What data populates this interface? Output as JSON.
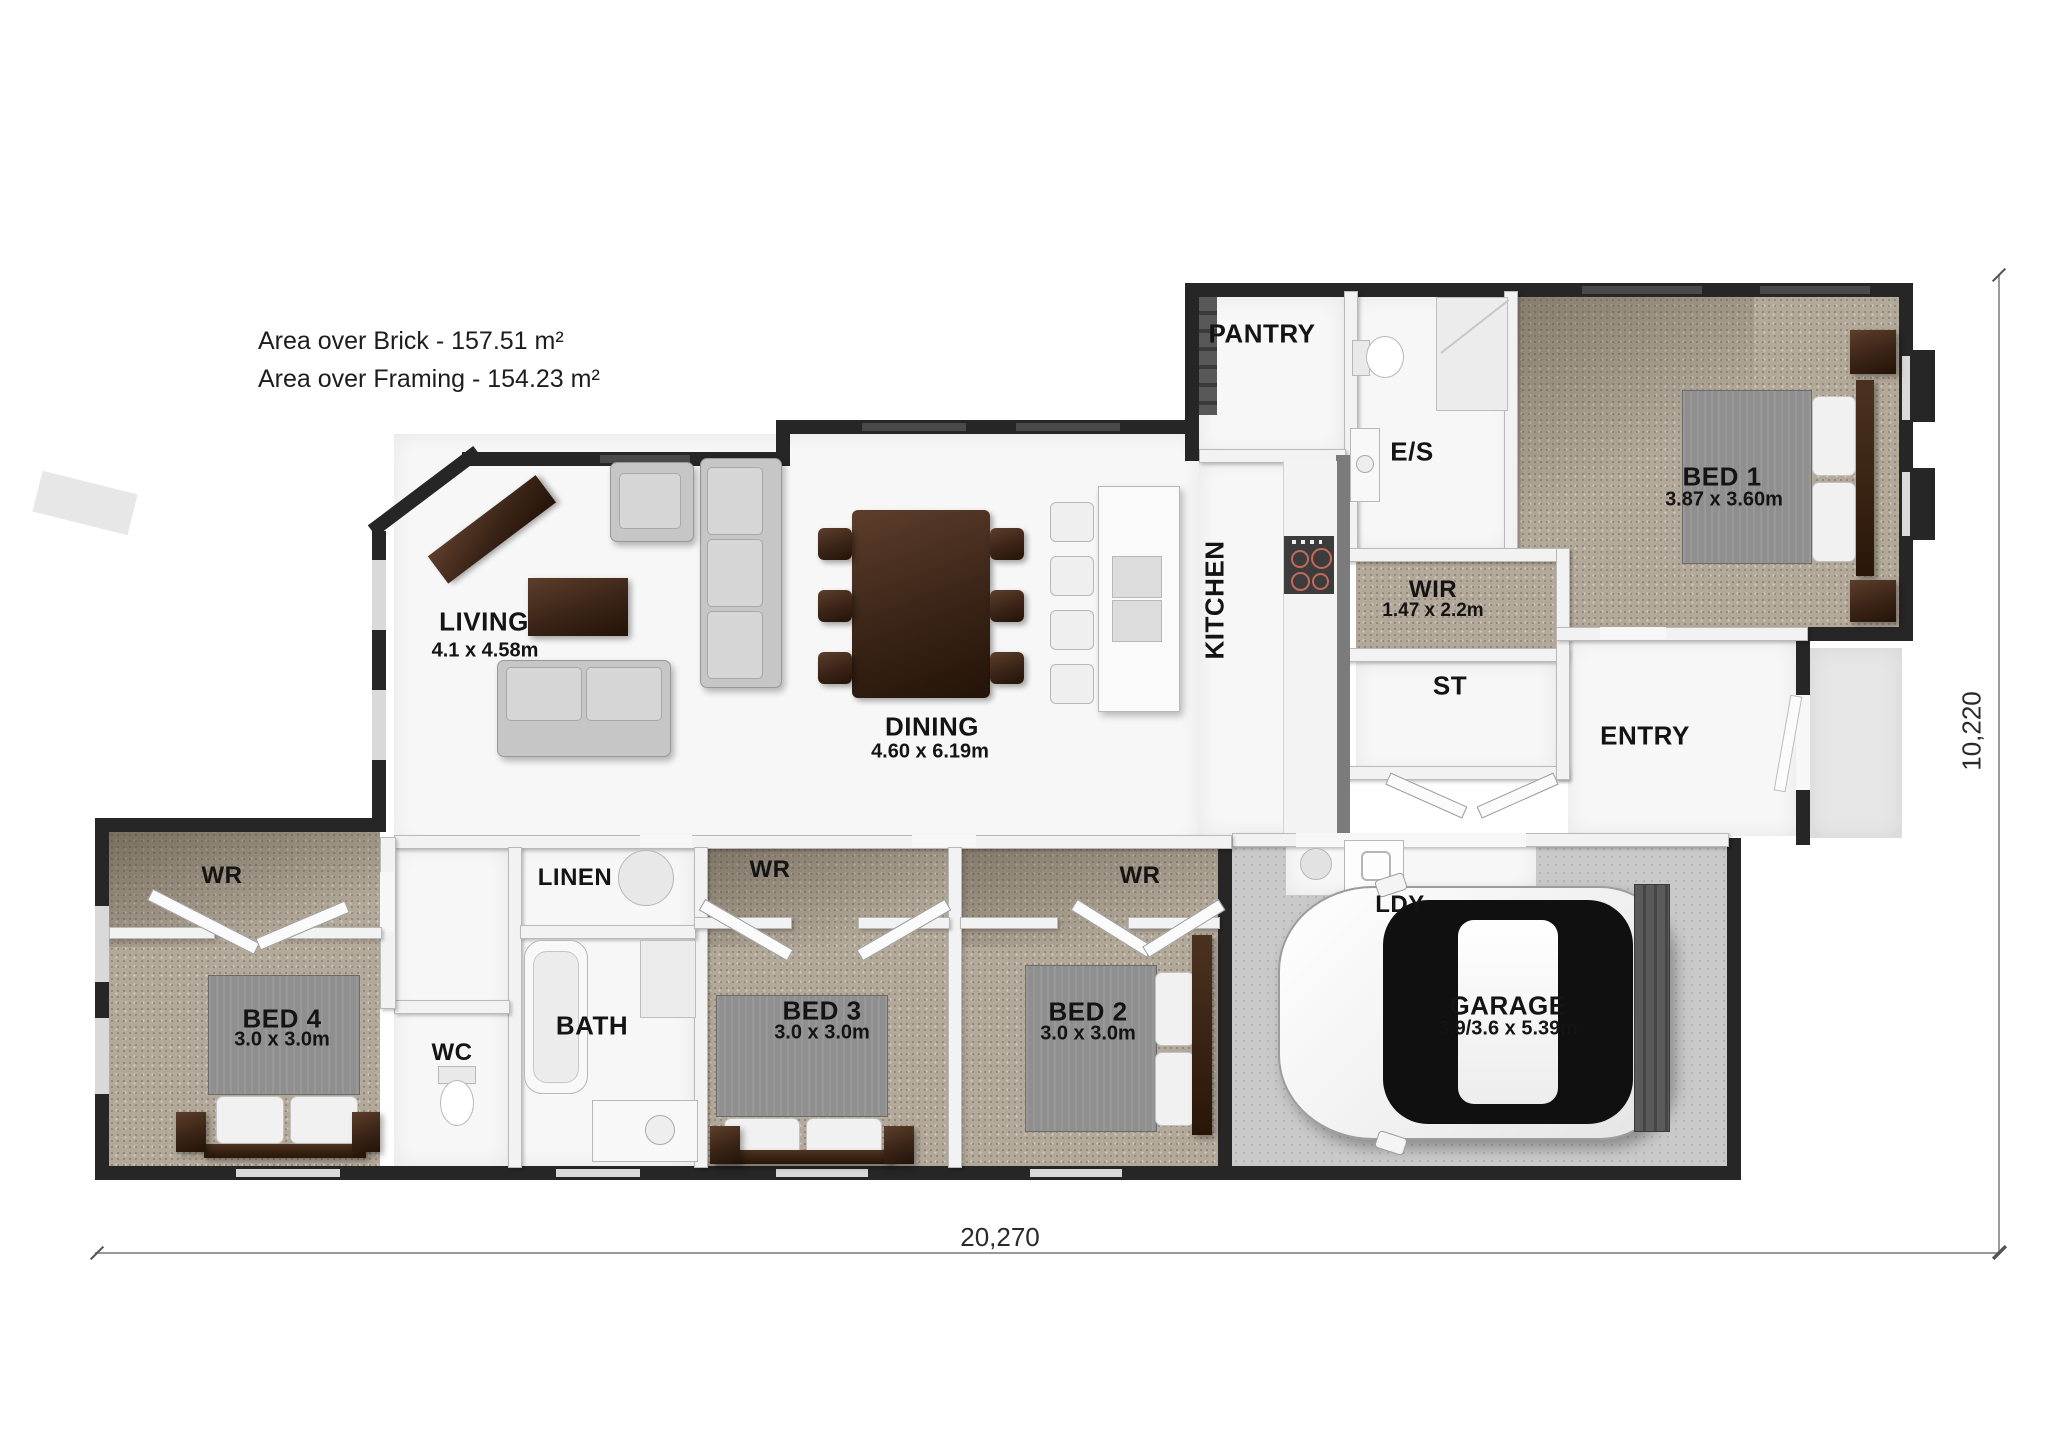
{
  "annotations": {
    "area_brick": "Area over Brick - 157.51 m²",
    "area_framing": "Area over Framing - 154.23 m²"
  },
  "dimensions": {
    "width": "20,270",
    "height": "10,220"
  },
  "rooms": {
    "pantry": {
      "name": "PANTRY"
    },
    "es": {
      "name": "E/S"
    },
    "bed1": {
      "name": "BED 1",
      "size": "3.87 x 3.60m"
    },
    "wir": {
      "name": "WIR",
      "size": "1.47 x 2.2m"
    },
    "st": {
      "name": "ST"
    },
    "kitchen": {
      "name": "KITCHEN"
    },
    "entry": {
      "name": "ENTRY"
    },
    "living": {
      "name": "LIVING",
      "size": "4.1 x 4.58m"
    },
    "dining": {
      "name": "DINING",
      "size": "4.60 x 6.19m"
    },
    "wr_bed4": {
      "name": "WR"
    },
    "linen": {
      "name": "LINEN"
    },
    "wr_bed3": {
      "name": "WR"
    },
    "wr_bed2": {
      "name": "WR"
    },
    "bed4": {
      "name": "BED 4",
      "size": "3.0 x 3.0m"
    },
    "wc": {
      "name": "WC"
    },
    "bath": {
      "name": "BATH"
    },
    "bed3": {
      "name": "BED 3",
      "size": "3.0 x 3.0m"
    },
    "bed2": {
      "name": "BED 2",
      "size": "3.0 x 3.0m"
    },
    "ldy": {
      "name": "LDY"
    },
    "garage": {
      "name": "GARAGE",
      "size": "3.9/3.6 x 5.39m"
    }
  },
  "colors": {
    "carpet": "#b3a99a",
    "exterior_wall": "#262626",
    "concrete": "#c9c9c9",
    "wood": "#3a2417",
    "burner_ring": "#b06050"
  }
}
